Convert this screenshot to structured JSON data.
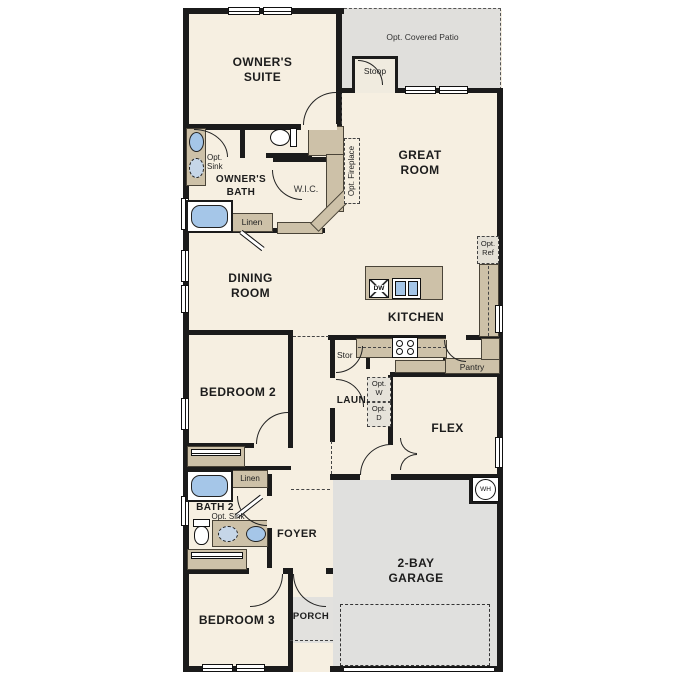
{
  "plan_type": "floor-plan",
  "rooms": {
    "owners_suite": "OWNER'S SUITE",
    "owners_bath": "OWNER'S BATH",
    "wic": "W.I.C.",
    "great_room": "GREAT ROOM",
    "dining_room": "DINING ROOM",
    "kitchen": "KITCHEN",
    "bedroom2": "BEDROOM 2",
    "laundry": "LAUN.",
    "flex": "FLEX",
    "bath2": "BATH 2",
    "foyer": "FOYER",
    "bedroom3": "BEDROOM 3",
    "porch": "PORCH",
    "garage": "2-BAY GARAGE"
  },
  "annotations": {
    "opt_covered_patio": "Opt. Covered Patio",
    "stoop": "Stoop",
    "opt_fireplace": "Opt. Fireplace",
    "opt_sink_owner": "Opt. Sink",
    "linen_owner": "Linen",
    "opt_ref": "Opt. Ref",
    "pantry": "Pantry",
    "stor": "Stor",
    "opt_w": "Opt. W",
    "opt_d": "Opt. D",
    "linen_bath2": "Linen",
    "opt_sink_bath2": "Opt. Sink"
  },
  "fixtures": {
    "dishwasher": "DW",
    "water_heater": "WH"
  },
  "colors": {
    "interior": "#f6efe1",
    "counter_tan": "#cdc1a8",
    "exterior_gray": "#e0dfdc",
    "fixture_blue": "#a5c6e8",
    "wall_black": "#1b1b1b"
  }
}
